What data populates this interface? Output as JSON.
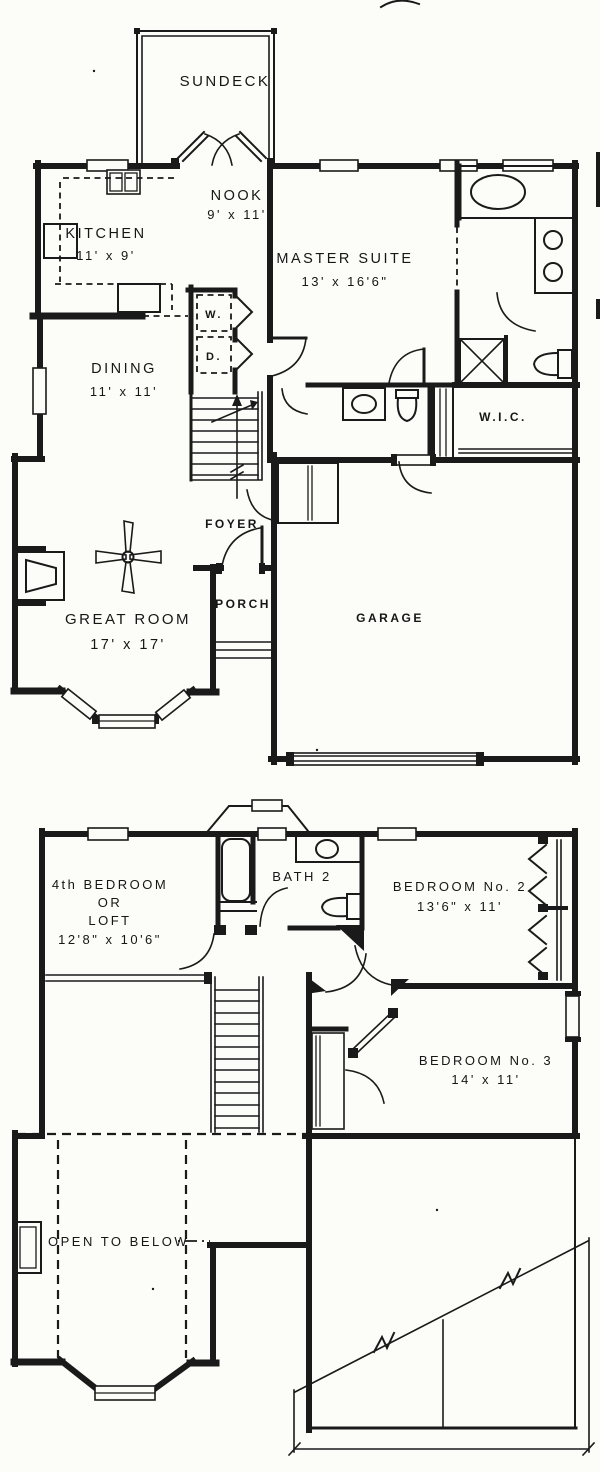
{
  "title": "Two-story house floor plan",
  "colors": {
    "ink": "#1a1a1a",
    "paper": "#fcfcf8"
  },
  "first_floor": {
    "sundeck": "SUNDECK",
    "nook_name": "NOOK",
    "nook_dims": "9' x 11'",
    "kitchen_name": "KITCHEN",
    "kitchen_dims": "11' x 9'",
    "master_name": "MASTER SUITE",
    "master_dims": "13' x 16'6\"",
    "washer": "W.",
    "dryer": "D.",
    "dining_name": "DINING",
    "dining_dims": "11' x 11'",
    "wic": "W.I.C.",
    "foyer": "FOYER",
    "great_name": "GREAT ROOM",
    "great_dims": "17' x 17'",
    "porch": "PORCH",
    "garage": "GARAGE"
  },
  "second_floor": {
    "bed4_line1": "4th BEDROOM",
    "bed4_line2": "OR",
    "bed4_line3": "LOFT",
    "bed4_dims": "12'8\" x 10'6\"",
    "bath2": "BATH 2",
    "bed2_name": "BEDROOM No. 2",
    "bed2_dims": "13'6\" x 11'",
    "bed3_name": "BEDROOM No. 3",
    "bed3_dims": "14' x 11'",
    "open_below": "OPEN TO BELOW"
  }
}
